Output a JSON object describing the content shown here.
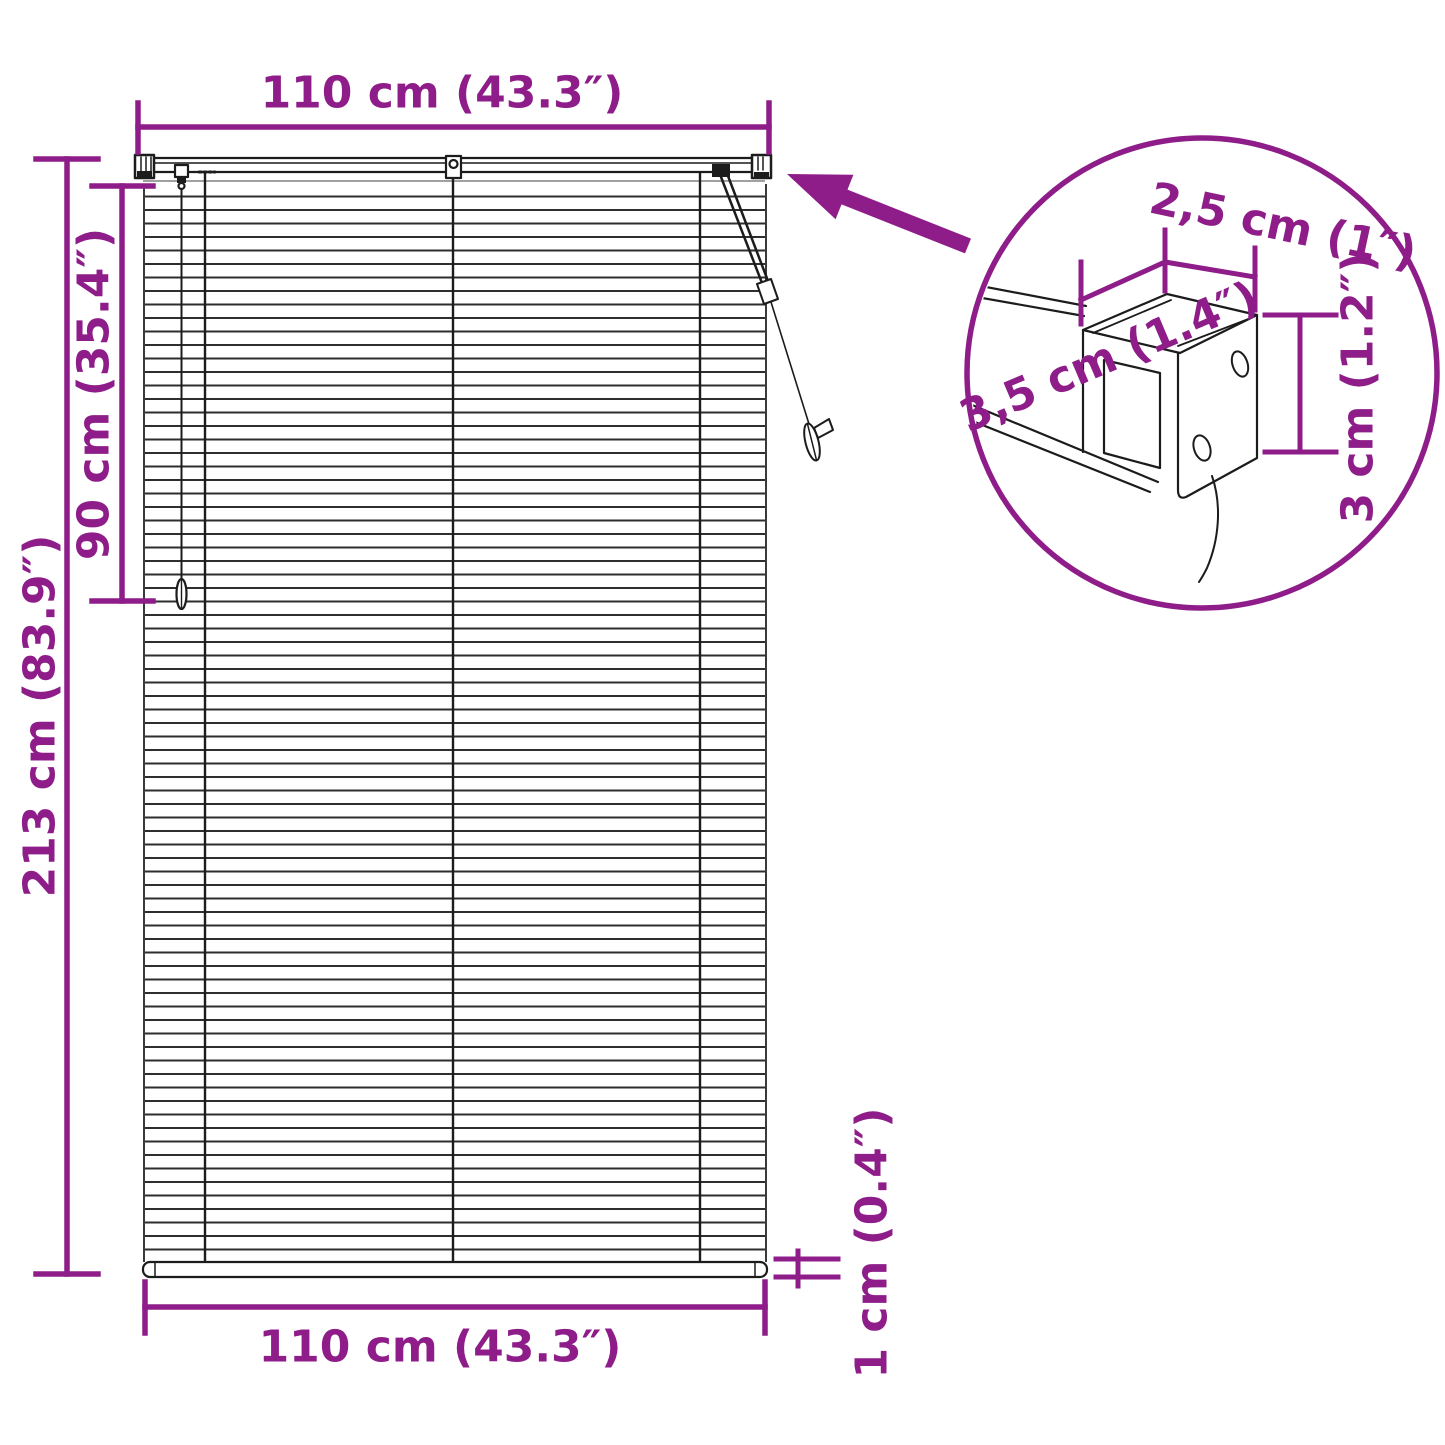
{
  "colors": {
    "accent": "#8e1d89",
    "ink": "#1c1c1c",
    "shadow": "#a0a0a0"
  },
  "labels": {
    "width_top": "110 cm (43.3″)",
    "height_total": "213 cm (83.9″)",
    "height_cord": "90 cm (35.4″)",
    "width_bottom": "110 cm (43.3″)",
    "rail_thickness": "1 cm (0.4″)"
  },
  "detail": {
    "bracket_width": "2,5 cm (1″)",
    "bracket_depth": "3,5 cm (1.4″)",
    "bracket_height": "3 cm (1.2″)"
  }
}
